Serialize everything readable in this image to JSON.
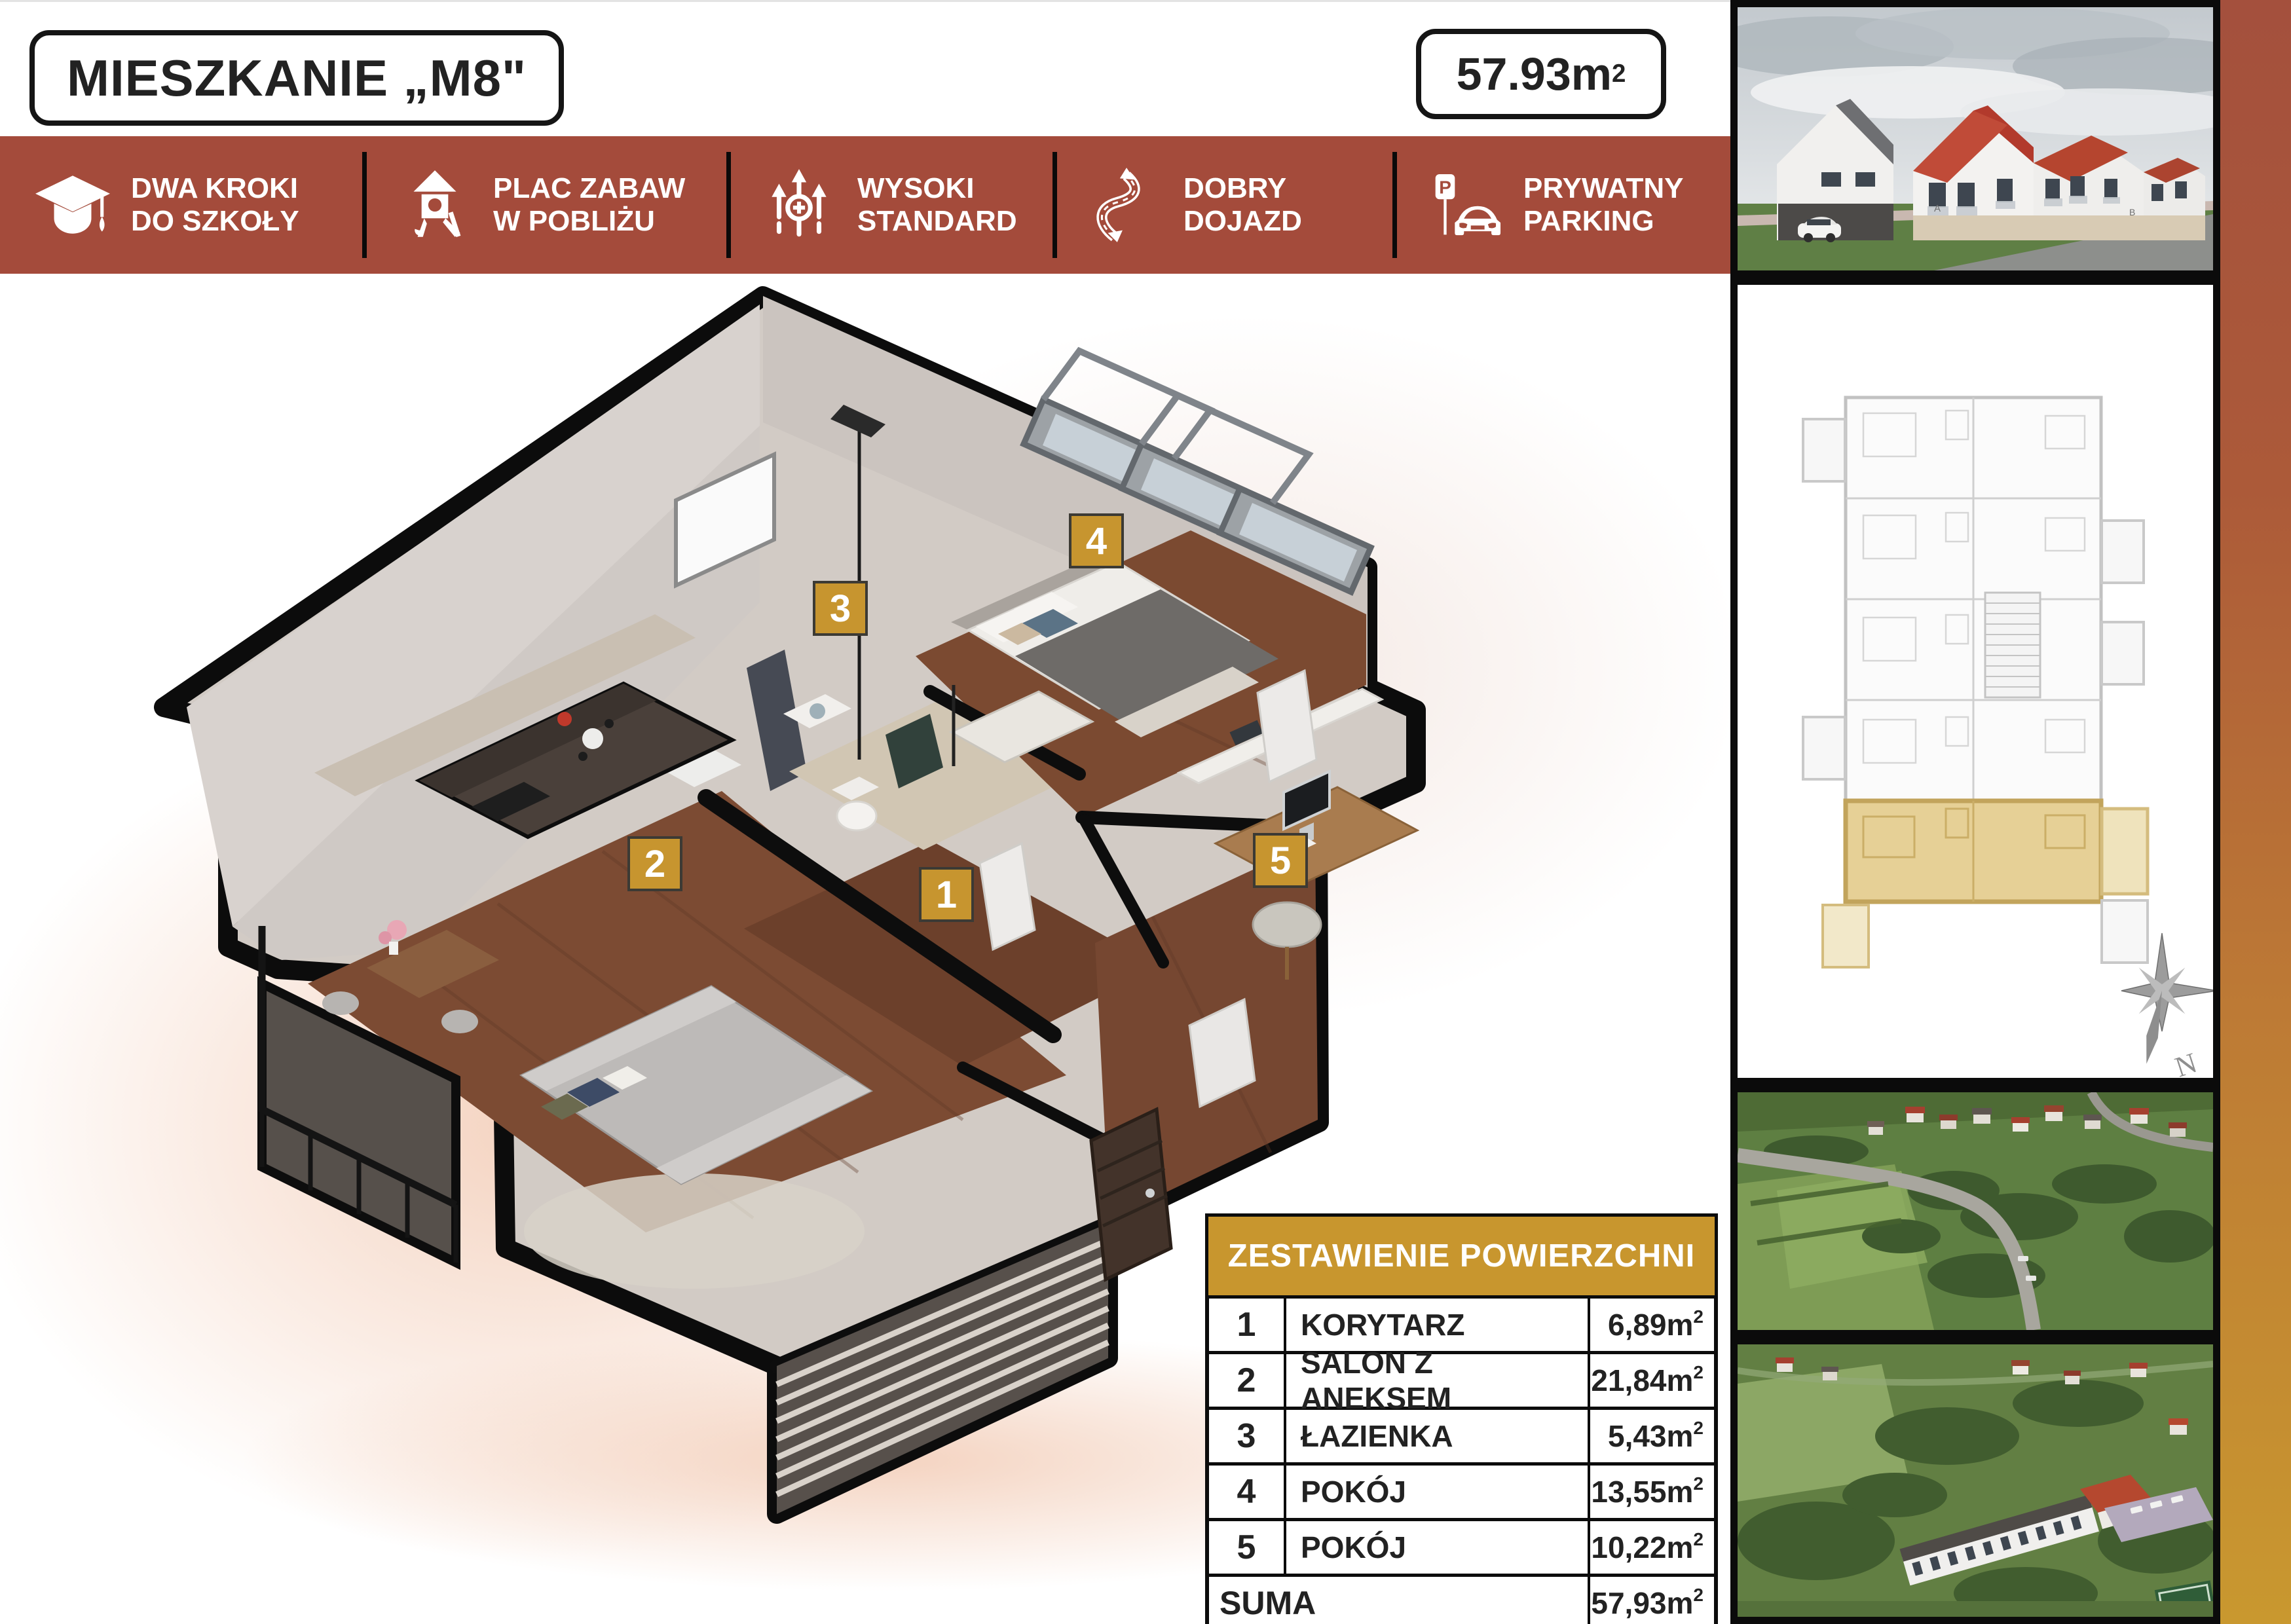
{
  "header": {
    "title": "MIESZKANIE „M8\"",
    "area_value": "57.93m",
    "area_sup": "2"
  },
  "features": {
    "items": [
      {
        "icon": "graduation-cap-icon",
        "line1": "DWA KROKI",
        "line2": "DO SZKOŁY"
      },
      {
        "icon": "playground-icon",
        "line1": "PLAC ZABAW",
        "line2": "W POBLIŻU"
      },
      {
        "icon": "quality-arrows-icon",
        "line1": "WYSOKI",
        "line2": "STANDARD"
      },
      {
        "icon": "road-icon",
        "line1": "DOBRY",
        "line2": "DOJAZD"
      },
      {
        "icon": "parking-icon",
        "line1": "PRYWATNY",
        "line2": "PARKING"
      }
    ]
  },
  "plan": {
    "markers": [
      {
        "n": "1"
      },
      {
        "n": "2"
      },
      {
        "n": "3"
      },
      {
        "n": "4"
      },
      {
        "n": "5"
      }
    ]
  },
  "area_table": {
    "title": "ZESTAWIENIE POWIERZCHNI",
    "unit": "m",
    "sup": "2",
    "rows": [
      {
        "no": "1",
        "name": "KORYTARZ",
        "value": "6,89"
      },
      {
        "no": "2",
        "name": "SALON Z ANEKSEM",
        "value": "21,84"
      },
      {
        "no": "3",
        "name": "ŁAZIENKA",
        "value": "5,43"
      },
      {
        "no": "4",
        "name": "POKÓJ",
        "value": "13,55"
      },
      {
        "no": "5",
        "name": "POKÓJ",
        "value": "10,22"
      }
    ],
    "total_label": "SUMA",
    "total_value": "57,93"
  },
  "sidebar": {
    "compass_label": "N",
    "building_letter_a": "A",
    "building_letter_b": "B"
  },
  "colors": {
    "banner": "#A44B3B",
    "gold": "#C7952F",
    "table_header": "#C8962E",
    "strip_top": "#A4503D",
    "strip_bottom": "#C9982F"
  }
}
